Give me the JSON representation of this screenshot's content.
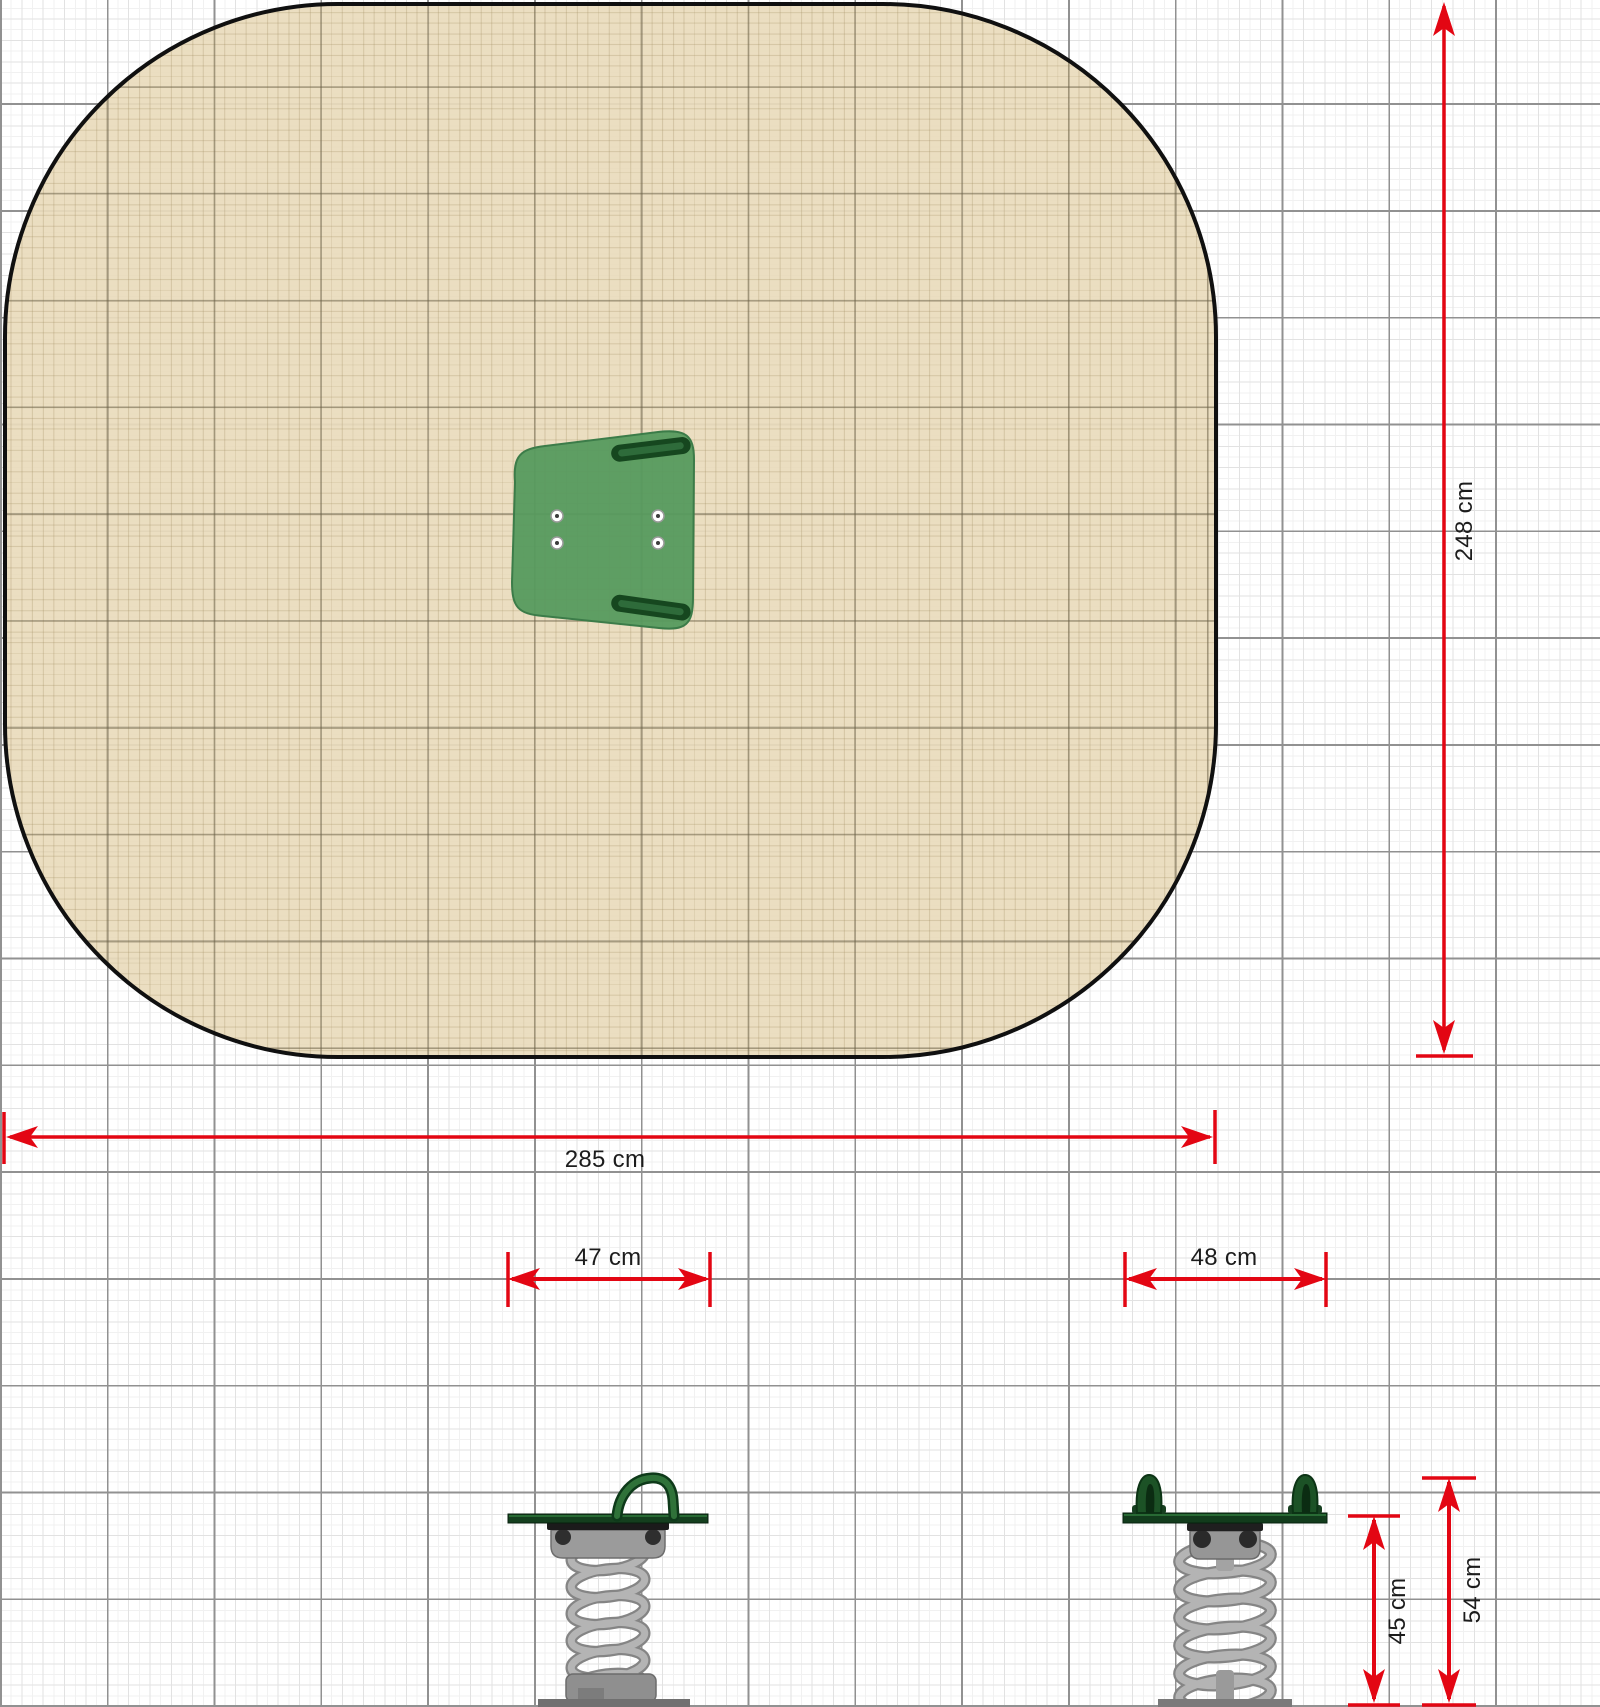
{
  "diagram": {
    "kind": "playground spring rocker dimensioned drawing",
    "views": {
      "top_view": "safety zone with seat top view",
      "side_view": "spring rocker side elevation",
      "front_view": "spring rocker front elevation"
    }
  },
  "dimensions": {
    "zone_width": "285 cm",
    "zone_depth": "248 cm",
    "side_width": "47 cm",
    "front_width": "48 cm",
    "seat_height": "45 cm",
    "handle_height": "54 cm"
  },
  "colors": {
    "dimension_red": "#e30613",
    "safety_zone_fill": "#e9dcbc",
    "zone_outline": "#101010",
    "seat_green": "#569a5e",
    "handle_green": "#16471f",
    "spring_gray": "#a9a9a9",
    "grid_major": "#919191"
  }
}
